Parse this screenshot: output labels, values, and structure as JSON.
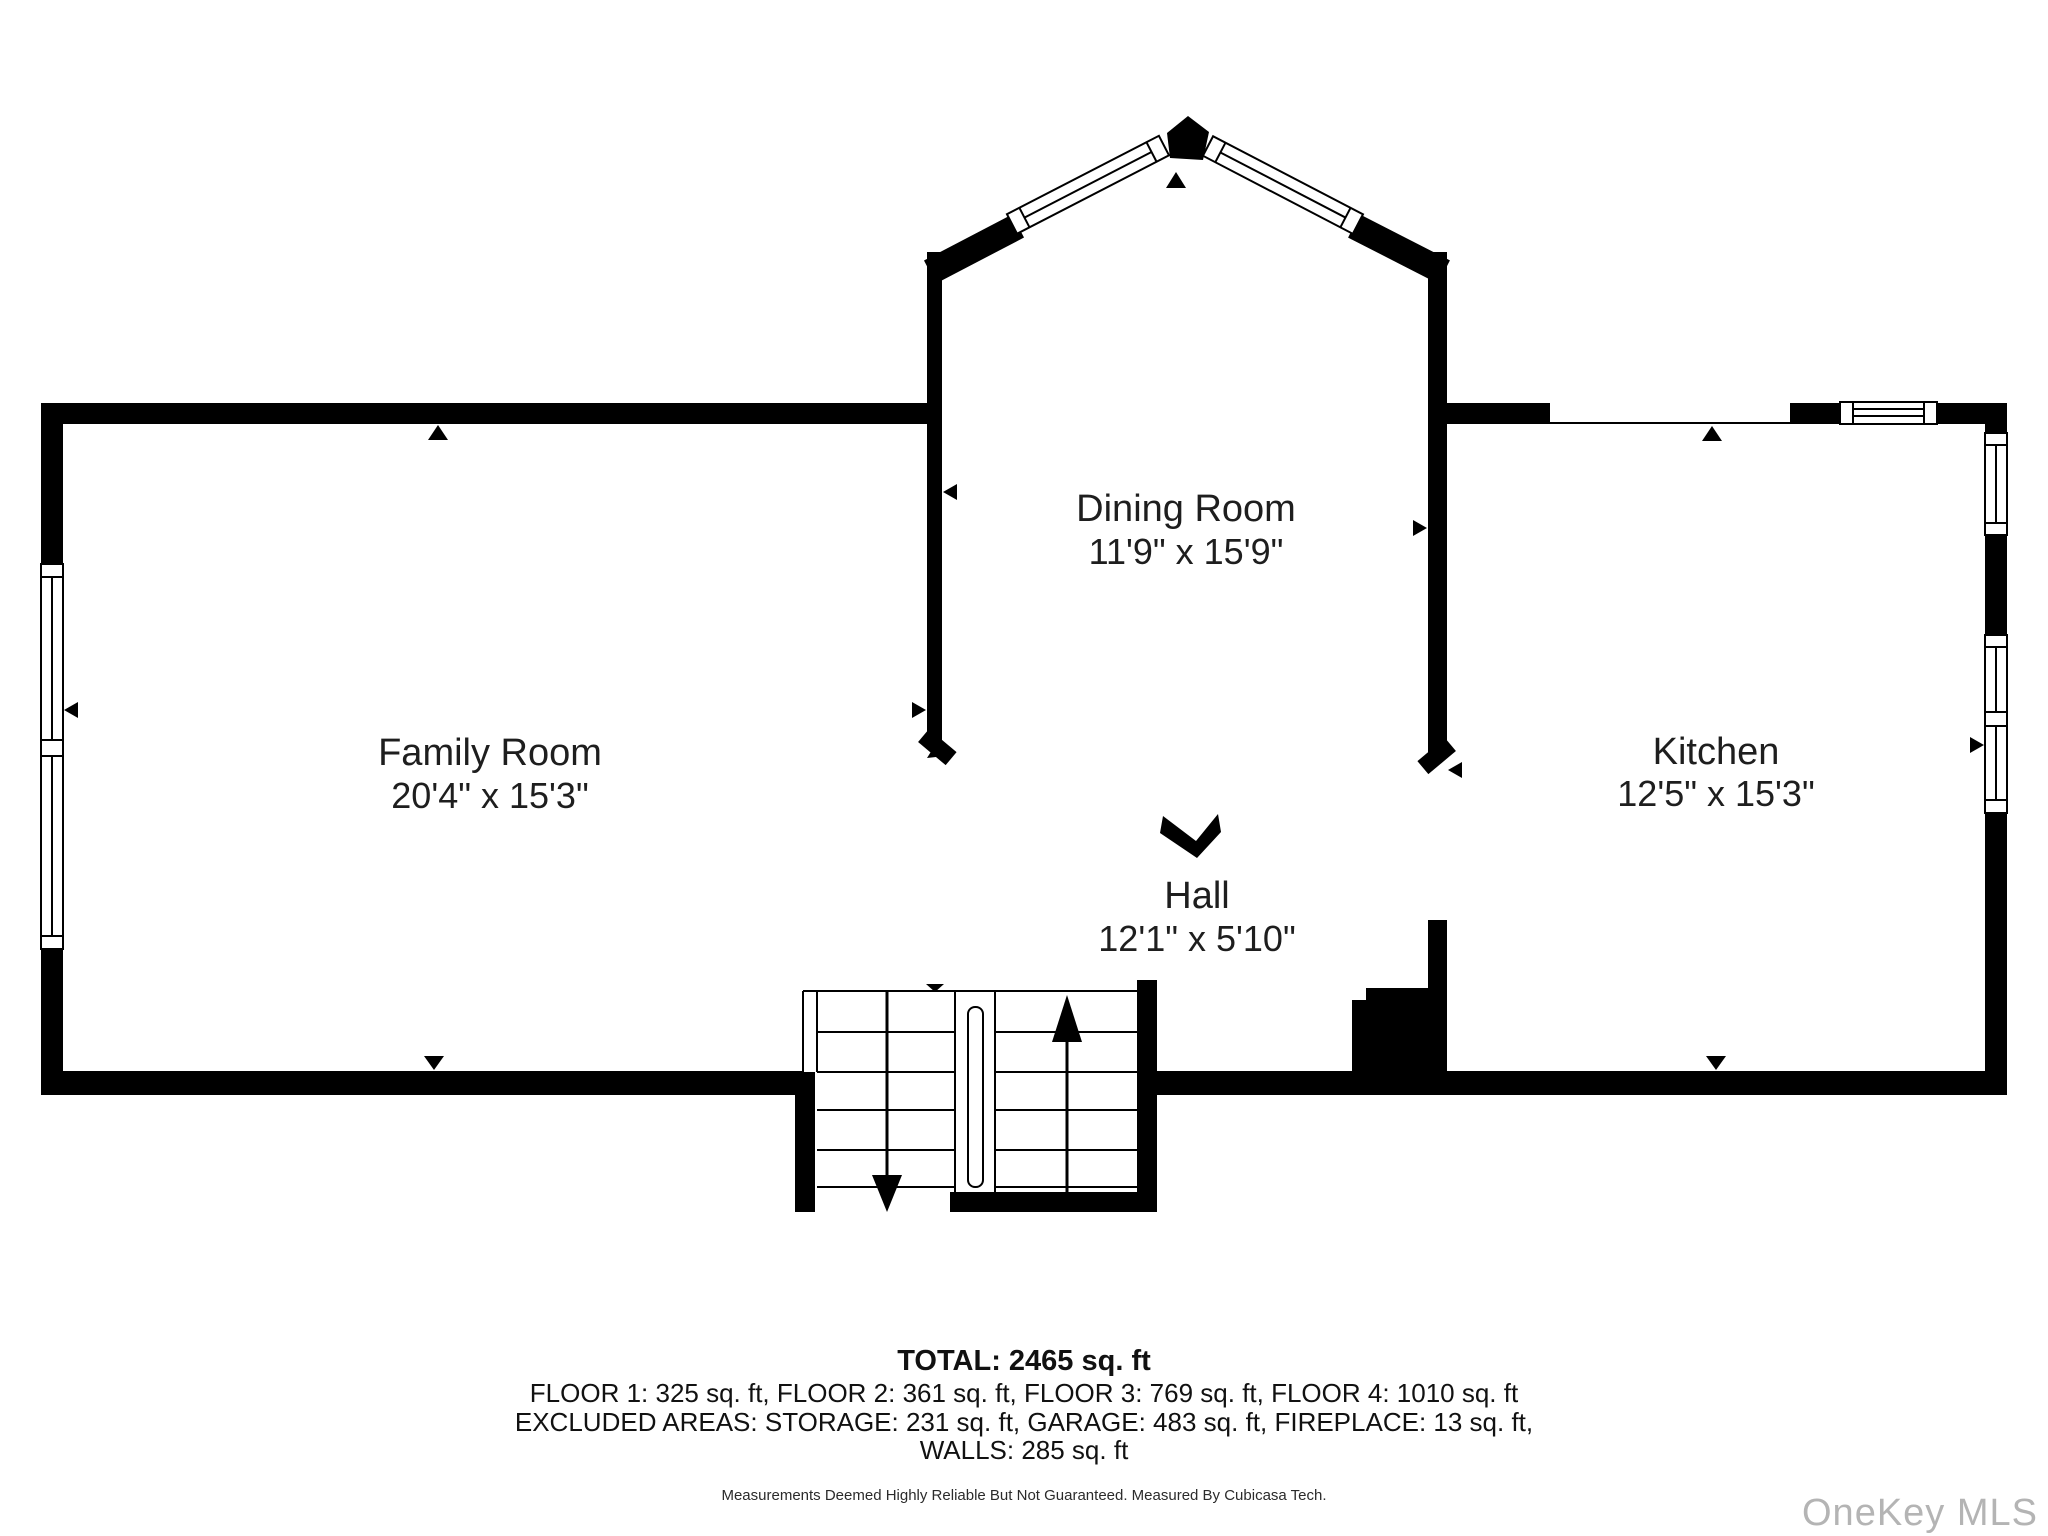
{
  "rooms": [
    {
      "id": "family-room",
      "name": "Family Room",
      "dimensions": "20'4\" x 15'3\""
    },
    {
      "id": "dining-room",
      "name": "Dining Room",
      "dimensions": "11'9\" x 15'9\""
    },
    {
      "id": "kitchen",
      "name": "Kitchen",
      "dimensions": "12'5\" x 15'3\""
    },
    {
      "id": "hall",
      "name": "Hall",
      "dimensions": "12'1\" x 5'10\""
    }
  ],
  "summary": {
    "total": "TOTAL: 2465 sq. ft",
    "floors": "FLOOR 1: 325 sq. ft, FLOOR 2: 361 sq. ft, FLOOR 3: 769 sq. ft, FLOOR 4: 1010 sq. ft",
    "excluded": "EXCLUDED AREAS: STORAGE: 231 sq. ft, GARAGE: 483 sq. ft, FIREPLACE: 13 sq. ft,",
    "walls": "WALLS: 285 sq. ft"
  },
  "disclaimer": "Measurements Deemed Highly Reliable But Not Guaranteed. Measured By Cubicasa Tech.",
  "watermark": "OneKey MLS",
  "colors": {
    "wall": "#000000",
    "text": "#1e1e1e",
    "watermark": "#b4b4b4"
  }
}
